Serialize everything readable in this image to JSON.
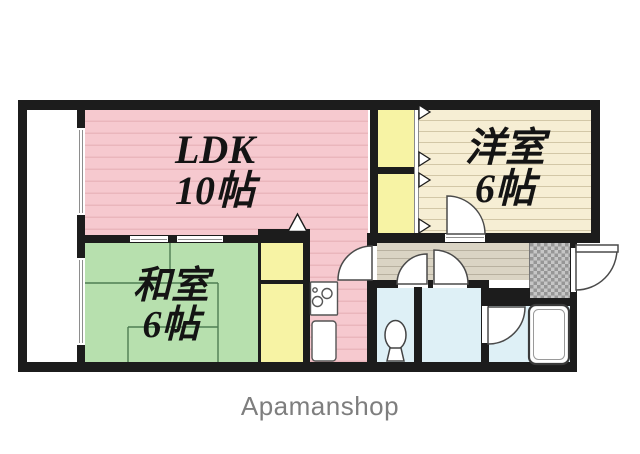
{
  "floorplan": {
    "title": "apartment-floor-plan",
    "rooms": {
      "ldk": {
        "label": "LDK",
        "size": "10帖"
      },
      "western": {
        "label": "洋室",
        "size": "6帖"
      },
      "japanese": {
        "label": "和室",
        "size": "6帖"
      }
    },
    "colors": {
      "wall": "#1c1c1c",
      "ldk_fill": "#f6c9cf",
      "ldk_line": "#eab6bc",
      "washitsu_fill": "#b7e0ae",
      "washitsu_line": "#4e7d52",
      "yoshitsu_fill": "#f6eed4",
      "yoshitsu_line": "#d2c7a7",
      "closet_fill": "#f7f3a4",
      "hall_fill": "#dad4c4",
      "hall_line": "#b8b1a0",
      "wet_fill": "#def0f6",
      "genkan_dark": "#969696",
      "genkan_light": "#c6c6c6",
      "door_stroke": "#4a4a4a",
      "brand_color": "#7e7e7e"
    }
  },
  "footer": {
    "brand": "Apamanshop"
  }
}
